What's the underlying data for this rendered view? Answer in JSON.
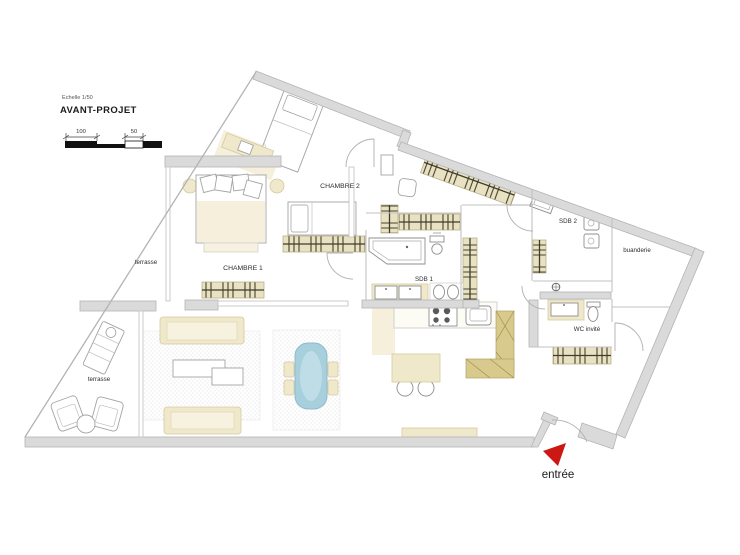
{
  "title_block": {
    "scale_note": "Echelle  1/50",
    "title": "AVANT-PROJET",
    "dim_100": "100",
    "dim_50": "50"
  },
  "rooms": {
    "chambre_1": "CHAMBRE 1",
    "chambre_2": "CHAMBRE 2",
    "sdb_1": "SDB 1",
    "sdb_2": "SDB 2",
    "buanderie": "buanderie",
    "wc_invite": "WC invité",
    "terrasse_upper": "terrasse",
    "terrasse_lower": "terrasse"
  },
  "entrance": {
    "label": "entrée"
  },
  "colors": {
    "wall": "#dadada",
    "wall_stroke": "#b4b4b4",
    "furniture_beige": "#efe8cb",
    "wardrobe_beige": "#e9e2c2",
    "cabinet_olive": "#d8ca8c",
    "table_blue": "#a8cfdc",
    "arrow_red": "#cc1712",
    "text": "#2d2d2d"
  }
}
